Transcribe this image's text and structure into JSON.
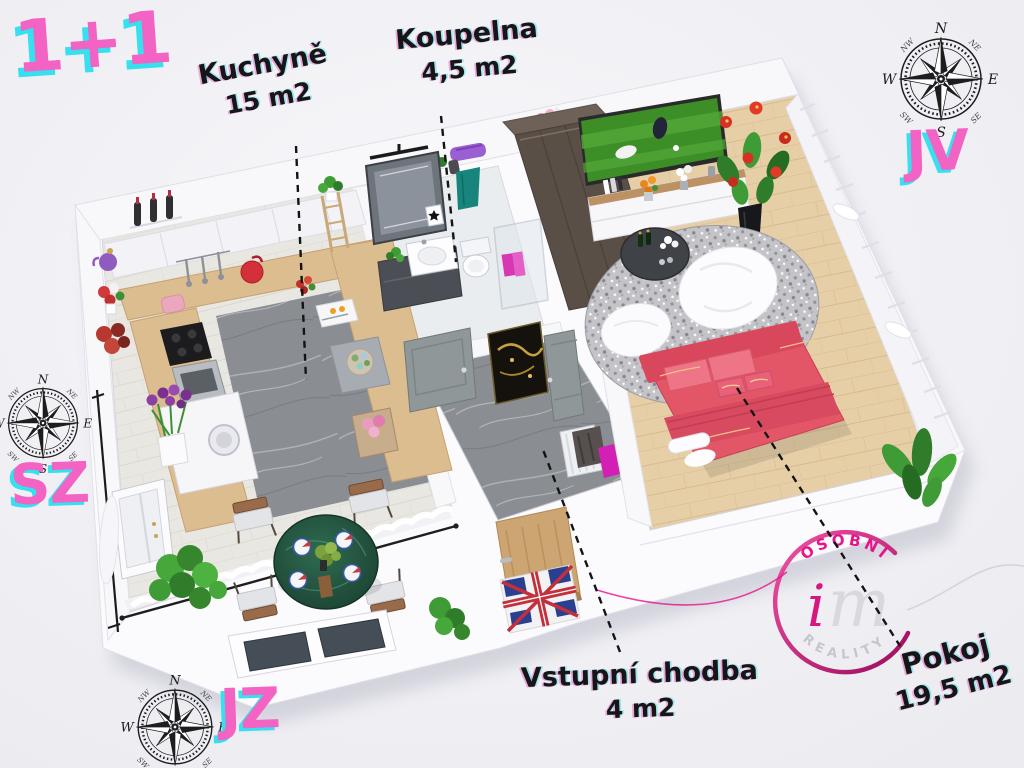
{
  "title": {
    "text": "1+1"
  },
  "rooms": [
    {
      "name": "Kuchyně",
      "area": "15 m2"
    },
    {
      "name": "Koupelna",
      "area": "4,5 m2"
    },
    {
      "name": "Vstupní chodba",
      "area": "4 m2"
    },
    {
      "name": "Pokoj",
      "area": "19,5 m2"
    }
  ],
  "orientation": {
    "top_right": "JV",
    "middle_left": "SZ",
    "bottom_left": "JZ"
  },
  "compass": {
    "n": "N",
    "e": "E",
    "s": "S",
    "w": "W",
    "ne": "NE",
    "se": "SE",
    "sw": "SW",
    "nw": "NW"
  },
  "logo": {
    "arc_top": "OSOBNÍ",
    "script_i": "i",
    "script_m": "m",
    "arc_bottom": "REALITY"
  },
  "colors": {
    "accent_pink": "#f263c3",
    "accent_cyan": "#37e0f1",
    "label_black": "#161616",
    "logo_pink": "#e8138b",
    "logo_gray": "#c6c6ce",
    "bed_red": "#e25667",
    "table_green": "#245240",
    "counter_wood": "#dcbd90",
    "room_wood": "#e6cfa7",
    "dining_wood": "#e9e7e1",
    "marble_gray": "#8a8e93",
    "wall_white": "#f8f8fb",
    "background": "#f1f1f5"
  },
  "icons": [
    "compass-rose-icon",
    "im-reality-logo",
    "leader-line"
  ]
}
